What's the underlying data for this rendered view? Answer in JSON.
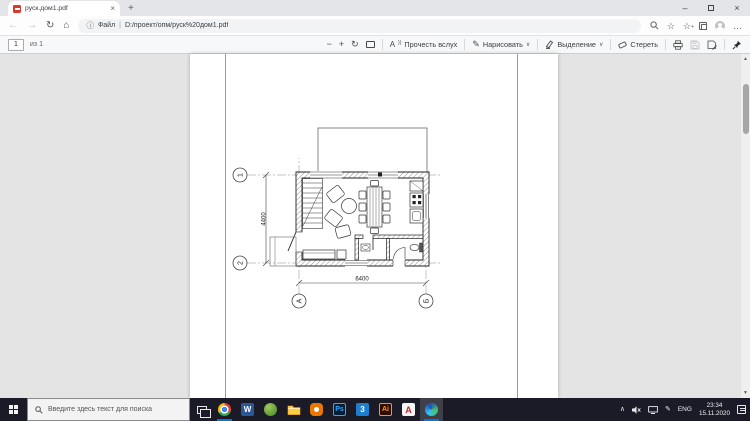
{
  "browser": {
    "tab_title": "руск.дом1.pdf",
    "address_prefix": "Файл",
    "address_url": "D:/проект/опм/руск%20дом1.pdf"
  },
  "icons": {
    "minimize": "–",
    "close": "×",
    "new_tab": "+",
    "back": "←",
    "forward": "→",
    "refresh": "↻",
    "home": "⌂",
    "info": "ⓘ",
    "divider": "|",
    "search": "⌕",
    "star": "☆",
    "star_plus": "+",
    "menu": "…",
    "zoom_out": "−",
    "zoom_in": "+",
    "rotate": "↻",
    "read_aloud_a": "A",
    "read_aloud_waves": "))",
    "chevron_down": "∨",
    "pen": "✎",
    "tray_chevron": "∧",
    "scroll_up": "▲",
    "scroll_down": "▼"
  },
  "pdf_toolbar": {
    "page_number": "1",
    "page_count": "из 1",
    "read_aloud": "Прочесть вслух",
    "draw": "Нарисовать",
    "highlight": "Выделение",
    "erase": "Стереть"
  },
  "drawing": {
    "dim_width": "6400",
    "dim_height": "4400",
    "axis_1": "1",
    "axis_2": "2",
    "axis_a": "А",
    "axis_b": "Б"
  },
  "taskbar": {
    "search_placeholder": "Введите здесь текст для поиска",
    "apps": [
      {
        "id": "task-view",
        "glyph": ""
      },
      {
        "id": "chrome",
        "glyph": ""
      },
      {
        "id": "word",
        "glyph": "W"
      },
      {
        "id": "green-app",
        "glyph": ""
      },
      {
        "id": "file-explorer",
        "glyph": ""
      },
      {
        "id": "blender",
        "glyph": ""
      },
      {
        "id": "photoshop",
        "glyph": "Ps"
      },
      {
        "id": "app-3d",
        "glyph": "3"
      },
      {
        "id": "illustrator",
        "glyph": "Ai"
      },
      {
        "id": "red-a-app",
        "glyph": "А"
      },
      {
        "id": "edge",
        "glyph": ""
      }
    ],
    "tray": {
      "language": "ENG",
      "time": "23:34",
      "date": "15.11.2020"
    }
  },
  "colors": {
    "pdf_red": "#D83B2E",
    "accent_blue": "#0078D7",
    "taskbar_bg": "#1B1B28",
    "viewer_bg": "#E4E4E4"
  }
}
